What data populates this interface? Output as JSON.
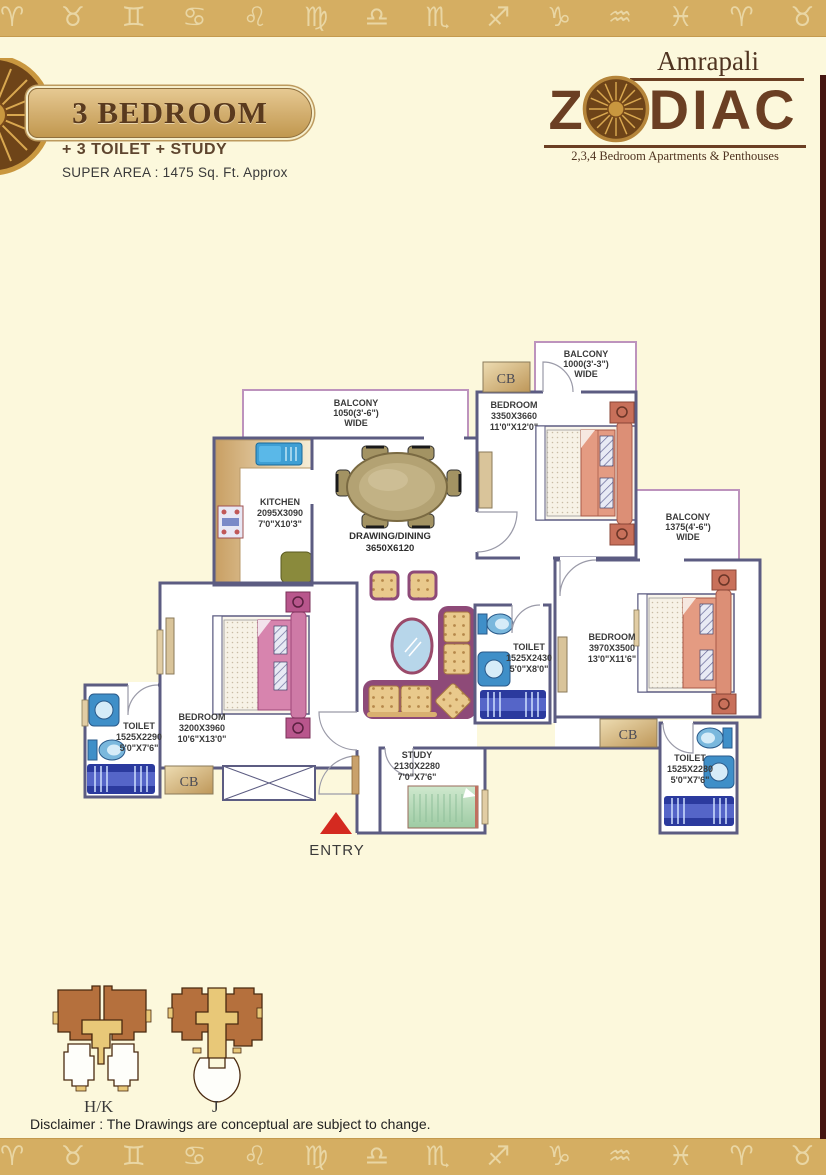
{
  "page": {
    "background": "#FCF8DC",
    "band_color": "#D5AE62",
    "right_strip_color": "#451510"
  },
  "zodiac_band_glyphs": "♈ ♉ ♊ ♋ ♌ ♍ ♎ ♏ ♐ ♑ ♒ ♓ ♈ ♉ ♊ ♋ ♌ ♍ ♎ ♏",
  "header": {
    "unit_title": "3 BEDROOM",
    "unit_subtitle": "+ 3 TOILET + STUDY",
    "super_area": "SUPER AREA : 1475 Sq. Ft. Approx",
    "brand_name": "Amrapali",
    "logo_z": "Z",
    "logo_diac": "DIAC",
    "tagline": "2,3,4 Bedroom Apartments & Penthouses"
  },
  "floor_plan": {
    "cupboard_label": "CB",
    "entry_label": "ENTRY",
    "rooms": {
      "balcony_tl": {
        "lines": [
          "BALCONY",
          "1050(3'-6\")",
          "WIDE"
        ]
      },
      "kitchen": {
        "lines": [
          "KITCHEN",
          "2095X3090",
          "7'0\"X10'3\""
        ]
      },
      "drawing_dining": {
        "lines": [
          "DRAWING/DINING",
          "3650X6120"
        ]
      },
      "bedroom_top_right": {
        "lines": [
          "BEDROOM",
          "3350X3660",
          "11'0\"X12'0\""
        ]
      },
      "balcony_top_right": {
        "lines": [
          "BALCONY",
          "1000(3'-3\")",
          "WIDE"
        ]
      },
      "balcony_right": {
        "lines": [
          "BALCONY",
          "1375(4'-6\")",
          "WIDE"
        ]
      },
      "bedroom_right": {
        "lines": [
          "BEDROOM",
          "3970X3500",
          "13'0\"X11'6\""
        ]
      },
      "toilet_center": {
        "lines": [
          "TOILET",
          "1525X2430",
          "5'0\"X8'0\""
        ]
      },
      "bedroom_left": {
        "lines": [
          "BEDROOM",
          "3200X3960",
          "10'6\"X13'0\""
        ]
      },
      "toilet_left": {
        "lines": [
          "TOILET",
          "1525X2290",
          "5'0\"X7'6\""
        ]
      },
      "study": {
        "lines": [
          "STUDY",
          "2130X2280",
          "7'0\"X7'6\""
        ]
      },
      "toilet_bottom_right": {
        "lines": [
          "TOILET",
          "1525X2280",
          "5'0\"X7'6\""
        ]
      }
    }
  },
  "key_plan": {
    "tower_1": "H/K",
    "tower_2": "J"
  },
  "footer": {
    "disclaimer": "Disclaimer : The Drawings are conceptual are subject to change."
  }
}
